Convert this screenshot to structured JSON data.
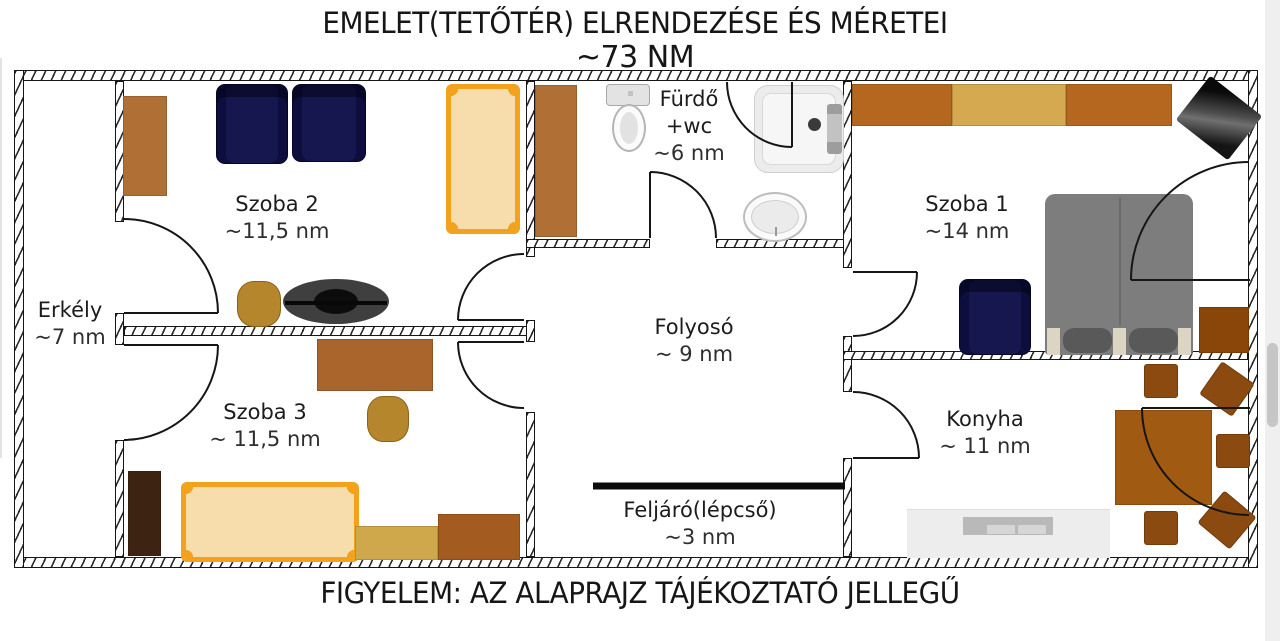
{
  "title": {
    "line1": "EMELET(TETŐTÉR) ELRENDEZÉSE ÉS MÉRETEI",
    "line2": "~73 NM"
  },
  "footer": {
    "text": "FIGYELEM: AZ ALAPRAJZ TÁJÉKOZTATÓ JELLEGŰ"
  },
  "total_area": "~73 NM",
  "rooms": [
    {
      "id": "erkely",
      "name": "Erkély",
      "area": "~7 nm"
    },
    {
      "id": "szoba2",
      "name": "Szoba 2",
      "area": "~11,5 nm"
    },
    {
      "id": "szoba3",
      "name": "Szoba 3",
      "area": "~ 11,5 nm"
    },
    {
      "id": "furdo",
      "name": "Fürdő",
      "extra": "+wc",
      "area": "~6 nm"
    },
    {
      "id": "folyoso",
      "name": "Folyosó",
      "area": "~ 9 nm"
    },
    {
      "id": "feljaro",
      "name": "Feljáró(lépcső)",
      "area": "~3 nm"
    },
    {
      "id": "szoba1",
      "name": "Szoba 1",
      "area": "~14 nm"
    },
    {
      "id": "konyha",
      "name": "Konyha",
      "area": "~ 11 nm"
    }
  ],
  "colors": {
    "wall": "#161616",
    "wood_brown": "#b06f35",
    "wardrobe_brown": "#b5671f",
    "wardrobe_tan": "#d4a94f",
    "dark_brown": "#3d2412",
    "navy_chair": "#171750",
    "bed_frame_orange": "#f2a21d",
    "bed_fill_tan": "#f6ddab",
    "gray_bed": "#7d7d7d",
    "counter_gray": "#ededed",
    "table_brown": "#a05a12",
    "kitchen_chair_brown": "#8a4a10",
    "gold_chair": "#b5862b"
  }
}
